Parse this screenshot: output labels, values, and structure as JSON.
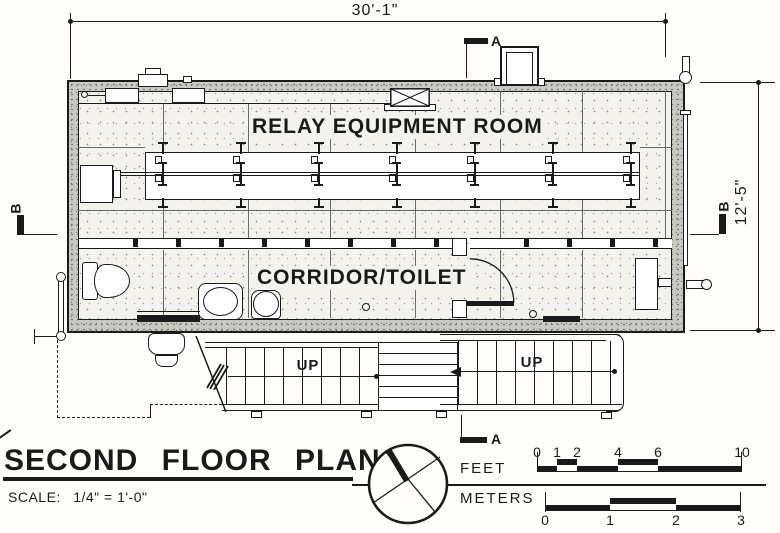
{
  "drawing": {
    "rooms": {
      "relay_room": "RELAY EQUIPMENT ROOM",
      "corridor": "CORRIDOR/TOILET"
    },
    "stairs": {
      "up_left": "UP",
      "up_right": "UP"
    },
    "dimensions": {
      "overall_width": "30'-1\"",
      "overall_depth": "12'-5\""
    },
    "section_markers": {
      "a_top": "A",
      "a_bottom": "A",
      "b_left": "B",
      "b_right": "B"
    }
  },
  "title_block": {
    "title": "SECOND FLOOR PLAN",
    "scale_label": "SCALE:",
    "scale_value": "1/4\" = 1'-0\""
  },
  "scale_bars": {
    "feet": {
      "label": "FEET",
      "ticks": [
        "0",
        "1",
        "2",
        "4",
        "6",
        "10"
      ]
    },
    "meters": {
      "label": "METERS",
      "ticks": [
        "0",
        "1",
        "2",
        "3"
      ]
    }
  },
  "icons": {
    "north_arrow": "north-arrow-compass"
  }
}
